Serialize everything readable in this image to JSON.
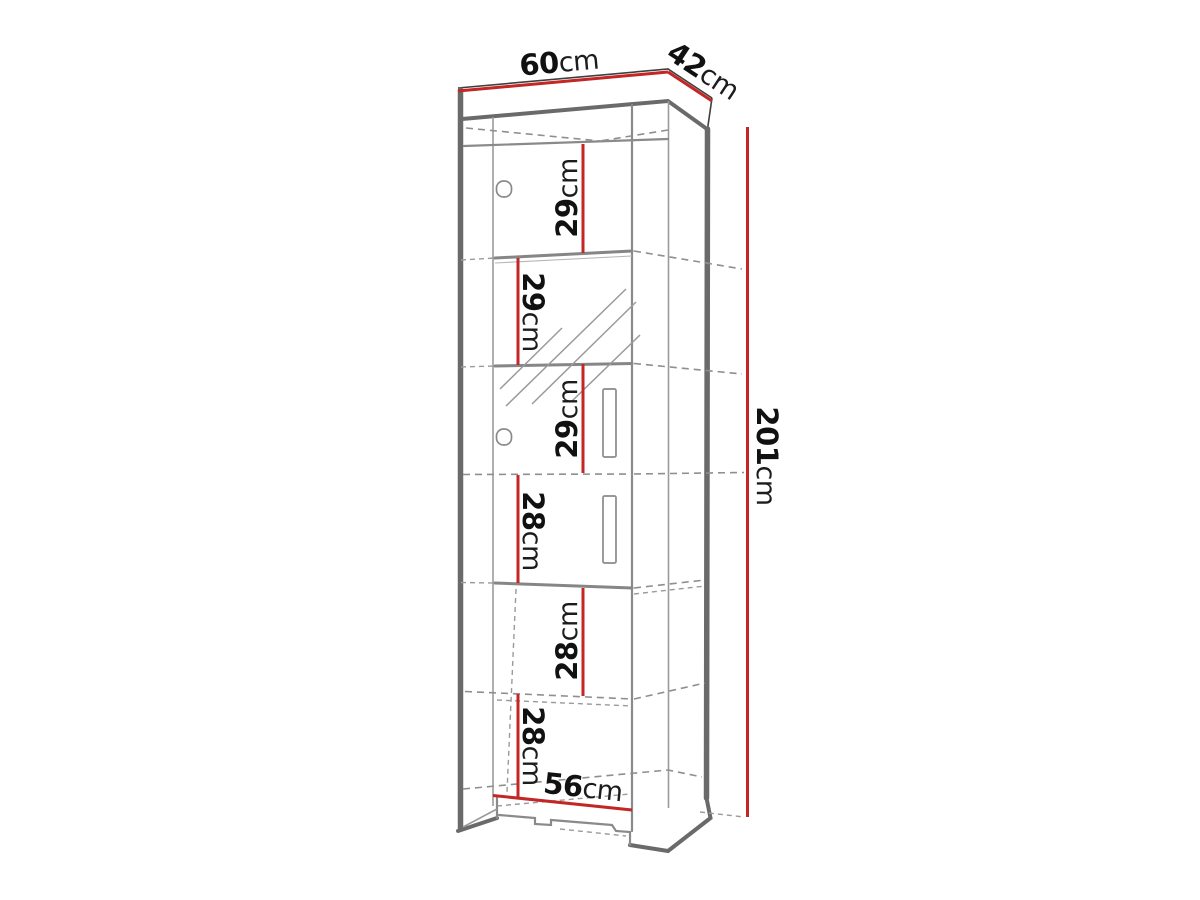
{
  "diagram": {
    "type": "furniture-dimension-drawing",
    "subject": "tall narrow cabinet with shelves, perspective line drawing",
    "labels": {
      "width": {
        "value": "60",
        "unit": "cm"
      },
      "depth": {
        "value": "42",
        "unit": "cm"
      },
      "height": {
        "value": "201",
        "unit": "cm"
      },
      "base_width": {
        "value": "56",
        "unit": "cm"
      },
      "sections": [
        {
          "value": "29",
          "unit": "cm"
        },
        {
          "value": "29",
          "unit": "cm"
        },
        {
          "value": "29",
          "unit": "cm"
        },
        {
          "value": "28",
          "unit": "cm"
        },
        {
          "value": "28",
          "unit": "cm"
        },
        {
          "value": "28",
          "unit": "cm"
        }
      ]
    },
    "colors": {
      "dimension_line": "#c42525",
      "outline_dark": "#6a6a6a",
      "outline_mid": "#8a8a8a",
      "text": "#111111",
      "background": "#ffffff"
    }
  }
}
